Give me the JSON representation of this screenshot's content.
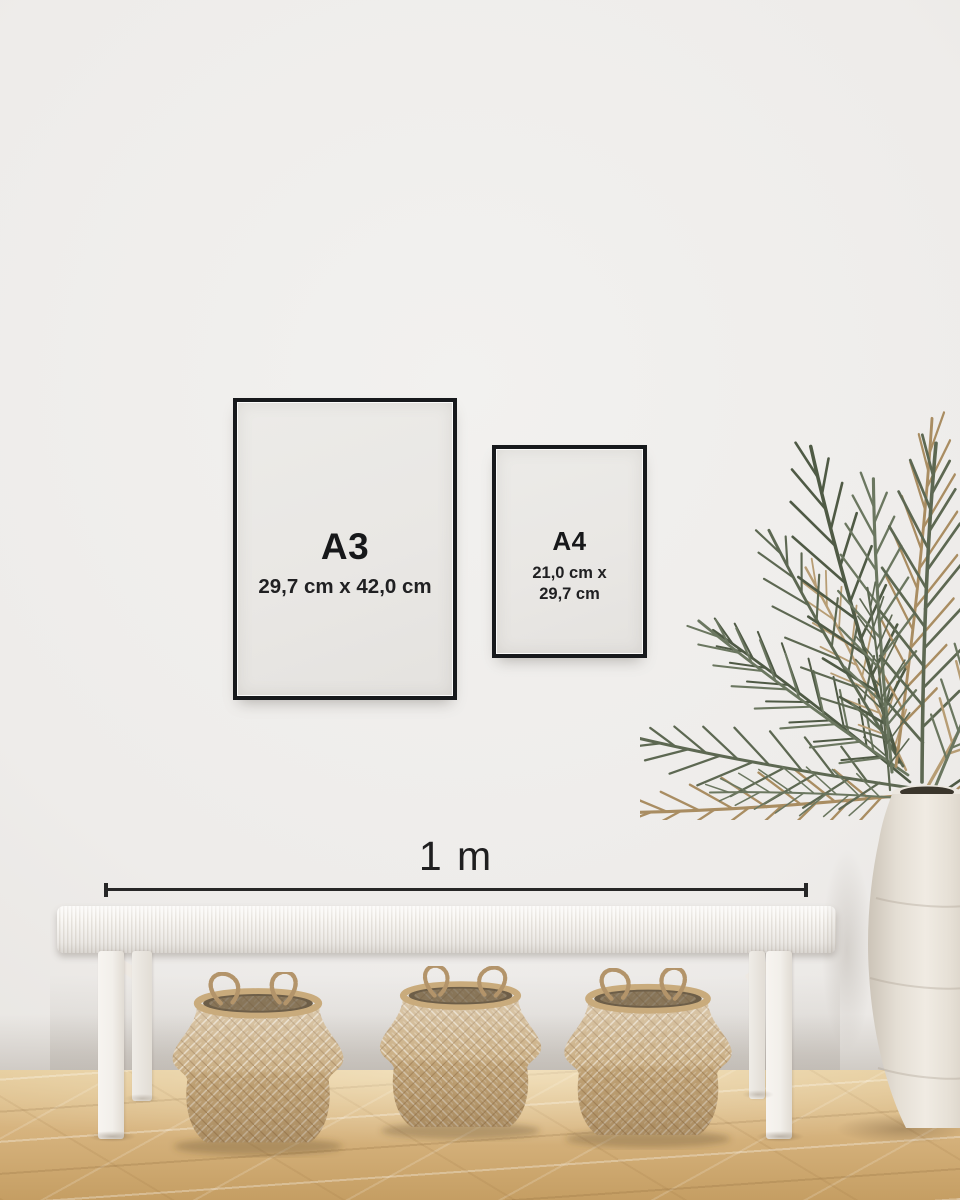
{
  "frames": {
    "a3": {
      "label": "A3",
      "dimensions": "29,7 cm x 42,0 cm"
    },
    "a4": {
      "label": "A4",
      "dimensions_line1": "21,0 cm x",
      "dimensions_line2": "29,7 cm"
    }
  },
  "scale_bar": {
    "label": "1 m"
  },
  "colors": {
    "frame_border": "#17191c",
    "frame_paper": "#e9e7e4",
    "label_text": "#17181a",
    "scale_line": "#272727",
    "wall": "#efeeec",
    "floor_light": "#e2c795",
    "floor_dark": "#c59e63",
    "bench_white": "#f3f0ec",
    "basket_tan": "#c7aa7d",
    "vase_white": "#eae5dc",
    "plant_green": "#5d6852",
    "plant_tan": "#a98d62"
  }
}
